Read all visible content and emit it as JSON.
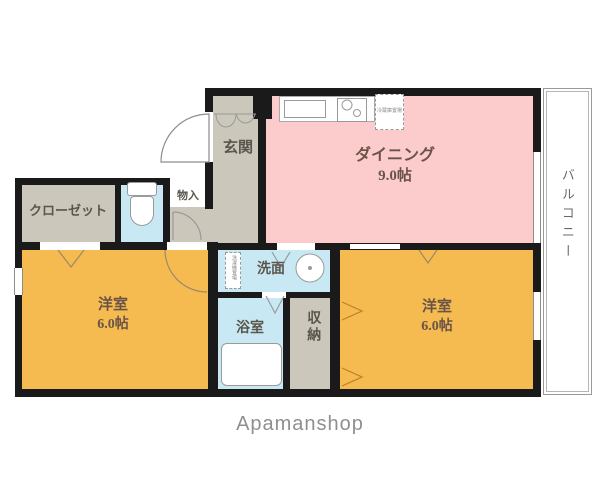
{
  "floorplan": {
    "rooms": {
      "dining": {
        "label": "ダイニング",
        "size": "9.0帖"
      },
      "bedroom_left": {
        "label": "洋室",
        "size": "6.0帖"
      },
      "bedroom_right": {
        "label": "洋室",
        "size": "6.0帖"
      },
      "closet": {
        "label": "クローゼット"
      },
      "entrance": {
        "label": "玄関"
      },
      "small_storage": {
        "label": "物入"
      },
      "washroom": {
        "label": "洗面"
      },
      "bathroom": {
        "label": "浴室"
      },
      "storage": {
        "label": "収納"
      },
      "balcony": {
        "label": "バルコニー"
      }
    },
    "annotations": {
      "refrigerator_space": "冷蔵庫置場",
      "washing_machine_space": "洗濯機置場"
    },
    "colors": {
      "dining": "#fccccd",
      "bedroom": "#f5ba50",
      "wet_area": "#c8e9f3",
      "hall": "#cbc7bb",
      "wall": "#1a1a1a"
    }
  },
  "footer": {
    "brand": "Apamanshop"
  }
}
